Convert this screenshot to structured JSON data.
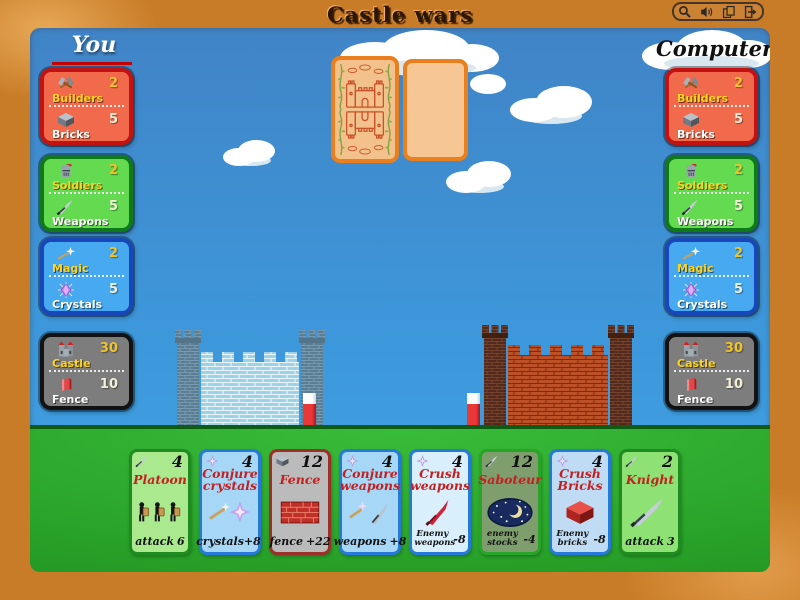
{
  "window": {
    "title": "Castle wars",
    "toolbar_icons": [
      "magnifier-icon",
      "sound-icon",
      "cards-icon",
      "exit-icon"
    ]
  },
  "colors": {
    "frame": "#c97c28",
    "sky": "#3d97da",
    "grass": "#2aa42a",
    "you_underline": "#c40000",
    "panel_builders_bg": "#f26a4c",
    "panel_builders_border": "#c41212",
    "panel_soldiers_bg": "#63da4f",
    "panel_soldiers_border": "#0f7a1a",
    "panel_magic_bg": "#47a9ef",
    "panel_magic_border": "#1747bb",
    "panel_castle_bg": "#7d7d7d",
    "panel_castle_border": "#121212",
    "card_back_bg": "#f3c18c",
    "card_back_border": "#ea7f1d",
    "card_title_red": "#c32020",
    "left_castle_brick": "#a2d4e6",
    "right_castle_brick": "#b54d20"
  },
  "players": {
    "you": {
      "name": "You",
      "panels": [
        {
          "rows": [
            {
              "label": "Builders",
              "value": "2",
              "icon": "builders-icon"
            },
            {
              "label": "Bricks",
              "value": "5",
              "icon": "bricks-icon"
            }
          ]
        },
        {
          "rows": [
            {
              "label": "Soldiers",
              "value": "2",
              "icon": "soldier-helmet-icon"
            },
            {
              "label": "Weapons",
              "value": "5",
              "icon": "sword-icon"
            }
          ]
        },
        {
          "rows": [
            {
              "label": "Magic",
              "value": "2",
              "icon": "magic-wand-icon"
            },
            {
              "label": "Crystals",
              "value": "5",
              "icon": "crystal-icon"
            }
          ]
        },
        {
          "rows": [
            {
              "label": "Castle",
              "value": "30",
              "icon": "castle-icon"
            },
            {
              "label": "Fence",
              "value": "10",
              "icon": "fence-brick-icon"
            }
          ]
        }
      ]
    },
    "computer": {
      "name": "Computer",
      "panels": [
        {
          "rows": [
            {
              "label": "Builders",
              "value": "2",
              "icon": "builders-icon"
            },
            {
              "label": "Bricks",
              "value": "5",
              "icon": "bricks-icon"
            }
          ]
        },
        {
          "rows": [
            {
              "label": "Soldiers",
              "value": "2",
              "icon": "soldier-helmet-icon"
            },
            {
              "label": "Weapons",
              "value": "5",
              "icon": "sword-icon"
            }
          ]
        },
        {
          "rows": [
            {
              "label": "Magic",
              "value": "2",
              "icon": "magic-wand-icon"
            },
            {
              "label": "Crystals",
              "value": "5",
              "icon": "crystal-icon"
            }
          ]
        },
        {
          "rows": [
            {
              "label": "Castle",
              "value": "30",
              "icon": "castle-icon"
            },
            {
              "label": "Fence",
              "value": "10",
              "icon": "fence-brick-icon"
            }
          ]
        }
      ]
    }
  },
  "hand": [
    {
      "name": "Platoon",
      "cost": "4",
      "corner_icon": "sword-icon",
      "art": "three-soldiers",
      "effect_text": "attack",
      "effect_value": "6"
    },
    {
      "name": "Conjure crystals",
      "cost": "4",
      "corner_icon": "sparkle-icon",
      "art": "wand-and-crystal",
      "effect_text": "crystals+8",
      "effect_value": ""
    },
    {
      "name": "Fence",
      "cost": "12",
      "corner_icon": "bricks-icon",
      "art": "brick-wall",
      "effect_text": "fence",
      "effect_value": "+22"
    },
    {
      "name": "Conjure weapons",
      "cost": "4",
      "corner_icon": "sparkle-icon",
      "art": "wand-and-sword",
      "effect_text": "weapons",
      "effect_value": "+8"
    },
    {
      "name": "Crush weapons",
      "cost": "4",
      "corner_icon": "sparkle-icon",
      "art": "red-sword",
      "effect_text": "Enemy weapons",
      "effect_value": "-8"
    },
    {
      "name": "Saboteur",
      "cost": "12",
      "corner_icon": "sword-icon",
      "art": "night-moon",
      "effect_text": "enemy stocks",
      "effect_value": "-4"
    },
    {
      "name": "Crush Bricks",
      "cost": "4",
      "corner_icon": "sparkle-icon",
      "art": "red-brick",
      "effect_text": "Enemy bricks",
      "effect_value": "-8"
    },
    {
      "name": "Knight",
      "cost": "2",
      "corner_icon": "sword-icon",
      "art": "sword",
      "effect_text": "attack",
      "effect_value": "3"
    }
  ]
}
